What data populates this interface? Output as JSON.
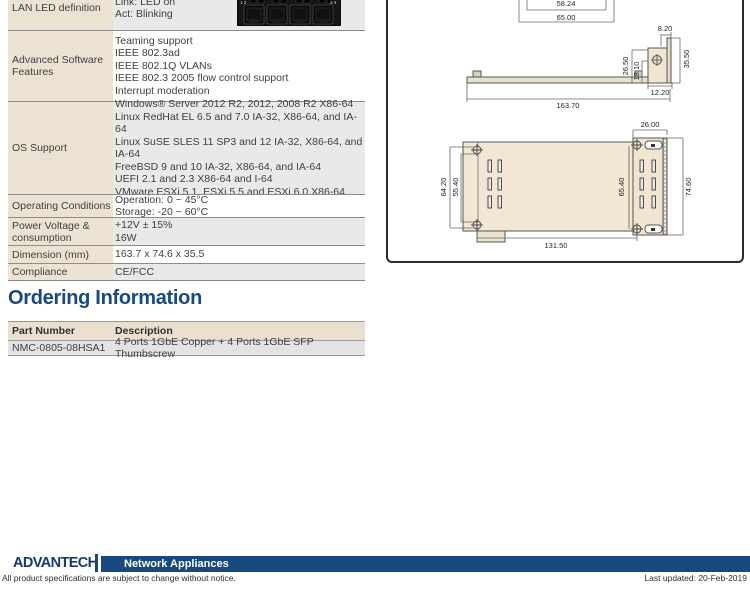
{
  "spec_table": {
    "rows": [
      {
        "label": "LAN LED definition",
        "lines": [
          "Link: LED on",
          "Act: Blinking"
        ],
        "image": "lan-ports"
      },
      {
        "label": "Advanced Software Features",
        "lines": [
          "Teaming support",
          "IEEE 802.3ad",
          "IEEE 802.1Q VLANs",
          "IEEE 802.3 2005 flow control support",
          "Interrupt moderation"
        ]
      },
      {
        "label": "OS Support",
        "lines": [
          "Windows® Server 2012 R2, 2012, 2008 R2 X86-64",
          "Linux RedHat EL 6.5 and 7.0 IA-32, X86-64, and IA-64",
          "Linux SuSE SLES 11 SP3 and 12 IA-32, X86-64, and IA-64",
          "FreeBSD 9 and 10 IA-32, X86-64, and IA-64",
          "UEFI 2.1 and 2.3 X86-64 and I-64",
          "VMware ESXi 5.1, ESXi 5.5 and ESXi 6.0 X86-64"
        ]
      },
      {
        "label": "Operating Conditions",
        "lines": [
          "Operation: 0 ~ 45°C",
          "Storage: -20 ~ 60°C"
        ]
      },
      {
        "label": "Power Voltage & consumption",
        "lines": [
          "+12V ± 15%",
          "16W"
        ]
      },
      {
        "label": "Dimension (mm)",
        "lines": [
          "163.7 x 74.6 x 35.5"
        ]
      },
      {
        "label": "Compliance",
        "lines": [
          "CE/FCC"
        ]
      }
    ],
    "port_labels": {
      "left": "1 2",
      "right": "3 4"
    }
  },
  "ordering": {
    "heading": "Ordering Information",
    "columns": [
      "Part Number",
      "Description"
    ],
    "rows": [
      [
        "NMC-0805-08HSA1",
        "4 Ports 1GbE Copper + 4 Ports 1GbE SFP Thumbscrew"
      ]
    ]
  },
  "drawing": {
    "top": {
      "width_inner": "58.24",
      "width_outer": "65.00"
    },
    "side": {
      "top_width": "8.20",
      "h1": "26.50",
      "h2": "18.10",
      "overall_height": "35.50",
      "bracket_depth": "12.20",
      "overall_length": "163.70"
    },
    "plan": {
      "front_depth": "26.00",
      "hole_span": "64.20",
      "slot_span": "55.40",
      "body_height": "65.40",
      "overall_height": "74.60",
      "body_length": "131.50"
    }
  },
  "footer": {
    "logo": "ADVANTECH",
    "banner": "Network Appliances",
    "disclaimer": "All product specifications are subject to change without notice.",
    "last_updated": "Last updated: 20-Feb-2019"
  },
  "colors": {
    "brand_navy": "#17497c",
    "heading_blue": "#18497f",
    "table_beige": "#ece2d3",
    "table_gray": "#e9e9e9",
    "board_fill": "#f1e7d3"
  }
}
